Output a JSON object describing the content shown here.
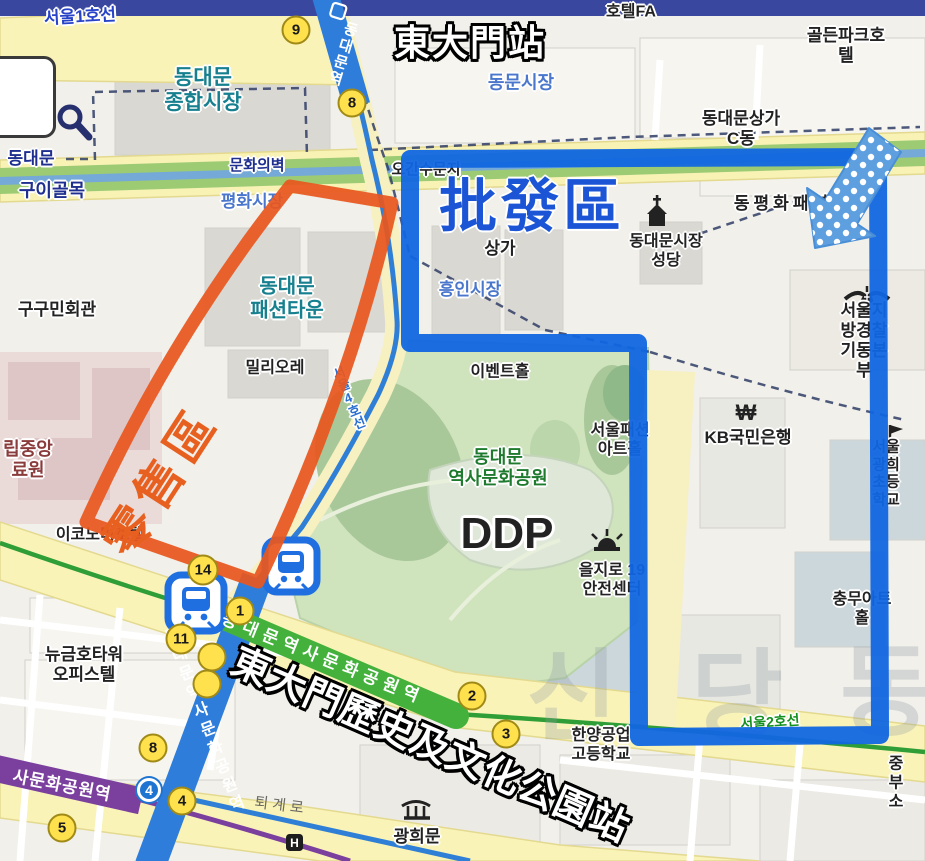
{
  "annotations": {
    "station_top": "東大門站",
    "wholesale_area": "批發區",
    "retail_area": "零售區",
    "station_bottom": "東大門歷史及文化公園站",
    "retail_color": "#e8571f",
    "wholesale_color": "#1166e0",
    "arrow_style": "blue-polka-dot"
  },
  "subway": {
    "badge4": "4",
    "ribbons": [
      {
        "id": "line4-top-name",
        "text": "동대문역",
        "x": 342,
        "y": 54,
        "rot": 17,
        "vertical": true,
        "size": 15,
        "spacing": 2
      },
      {
        "id": "line4-south-name",
        "text": "동대문역사문화공원역",
        "x": 202,
        "y": 722,
        "rot": -21,
        "vertical": true,
        "size": 16,
        "spacing": 4
      },
      {
        "id": "line2-name",
        "text": "동대문역사문화공원역",
        "x": 323,
        "y": 659,
        "rot": 22,
        "vertical": false,
        "size": 17,
        "spacing": 6
      },
      {
        "id": "line5-name",
        "text": "사문화공원역",
        "x": 62,
        "y": 786,
        "rot": 11,
        "vertical": false,
        "size": 17,
        "spacing": 1
      }
    ]
  },
  "stations": [
    {
      "n": "9",
      "x": 296,
      "y": 30
    },
    {
      "n": "8",
      "x": 352,
      "y": 103
    },
    {
      "n": "14",
      "x": 203,
      "y": 570
    },
    {
      "n": "1",
      "x": 240,
      "y": 611
    },
    {
      "n": "11",
      "x": 181,
      "y": 639
    },
    {
      "n": "",
      "x": 212,
      "y": 657
    },
    {
      "n": "",
      "x": 207,
      "y": 684
    },
    {
      "n": "8",
      "x": 153,
      "y": 748
    },
    {
      "n": "4",
      "x": 182,
      "y": 801
    },
    {
      "n": "5",
      "x": 62,
      "y": 828
    },
    {
      "n": "2",
      "x": 472,
      "y": 696
    },
    {
      "n": "3",
      "x": 506,
      "y": 734
    }
  ],
  "labels": [
    {
      "id": "seoul-line1",
      "t": "서울1호선",
      "x": 80,
      "y": 17,
      "s": 17,
      "c": "line1",
      "b": 1,
      "r": -3,
      "halo": 1
    },
    {
      "id": "hotel-fa",
      "t": "호텔FA",
      "x": 631,
      "y": 13,
      "s": 16,
      "c": "black",
      "b": 1,
      "halo": 1
    },
    {
      "id": "golden-park-hotel",
      "t": "골든파크호텔",
      "x": 846,
      "y": 46,
      "s": 17,
      "c": "black",
      "b": 1,
      "halo": 1
    },
    {
      "id": "ddm-jonghap-market",
      "t": "동대문\n종합시장",
      "x": 203,
      "y": 91,
      "s": 21,
      "c": "teal",
      "b": 1,
      "halo": 1
    },
    {
      "id": "dongmun-market",
      "t": "동문시장",
      "x": 521,
      "y": 83,
      "s": 18,
      "c": "bluem",
      "b": 1,
      "halo": 1
    },
    {
      "id": "ddm-sangga-c",
      "t": "동대문상가\nC동",
      "x": 741,
      "y": 129,
      "s": 17,
      "c": "black",
      "b": 1,
      "halo": 1
    },
    {
      "id": "munhwa-wall",
      "t": "문화의벽",
      "x": 257,
      "y": 166,
      "s": 15,
      "c": "navy",
      "b": 1,
      "halo": 1
    },
    {
      "id": "ogansu-munji",
      "t": "오간수문지",
      "x": 426,
      "y": 170,
      "s": 15,
      "c": "black",
      "b": 1,
      "halo": 1
    },
    {
      "id": "dongdaemun-west",
      "t": "동대문",
      "x": 31,
      "y": 159,
      "s": 17,
      "c": "navy",
      "b": 1,
      "halo": 1
    },
    {
      "id": "gui-golmok",
      "t": "구이골목",
      "x": 52,
      "y": 191,
      "s": 18,
      "c": "navy",
      "b": 1,
      "halo": 1
    },
    {
      "id": "pyeonghwa-market",
      "t": "평화시장",
      "x": 252,
      "y": 202,
      "s": 17,
      "c": "bluem",
      "b": 1,
      "halo": 1
    },
    {
      "id": "dongpyeonghwa",
      "t": "동평화패션",
      "x": 783,
      "y": 204,
      "s": 17,
      "c": "black",
      "b": 1,
      "halo": 1,
      "sp": 4
    },
    {
      "id": "ddm-catholic",
      "t": "동대문시장\n성당",
      "x": 666,
      "y": 252,
      "s": 16,
      "c": "black",
      "b": 1,
      "halo": 1
    },
    {
      "id": "sangga",
      "t": "상가",
      "x": 500,
      "y": 249,
      "s": 17,
      "c": "black",
      "b": 1,
      "halo": 1
    },
    {
      "id": "heungin-market",
      "t": "흥인시장",
      "x": 470,
      "y": 290,
      "s": 17,
      "c": "bluem",
      "b": 1,
      "halo": 1
    },
    {
      "id": "gugumin-hall",
      "t": "구구민회관",
      "x": 57,
      "y": 310,
      "s": 17,
      "c": "black",
      "b": 1,
      "halo": 1
    },
    {
      "id": "ddm-fashion-town",
      "t": "동대문\n패션타운",
      "x": 287,
      "y": 299,
      "s": 20,
      "c": "teal",
      "b": 1,
      "halo": 1
    },
    {
      "id": "police-hq",
      "t": "서울지방경찰\n기동본부",
      "x": 864,
      "y": 341,
      "s": 17,
      "c": "black",
      "b": 1,
      "halo": 1
    },
    {
      "id": "milliore",
      "t": "밀리오레",
      "x": 275,
      "y": 369,
      "s": 16,
      "c": "black",
      "b": 1,
      "halo": 1
    },
    {
      "id": "event-hall",
      "t": "이벤트홀",
      "x": 500,
      "y": 373,
      "s": 16,
      "c": "black",
      "b": 1,
      "halo": 1
    },
    {
      "id": "nmc",
      "t": "립중앙\n료원",
      "x": 28,
      "y": 460,
      "s": 18,
      "c": "maroon",
      "b": 1,
      "halo": 1
    },
    {
      "id": "seoul-line4",
      "t": "서울4호선",
      "x": 348,
      "y": 398,
      "s": 13,
      "c": "line4",
      "b": 1,
      "r": -22,
      "v": 1,
      "halo": 1
    },
    {
      "id": "ddp-park",
      "t": "동대문\n역사문화공원",
      "x": 498,
      "y": 468,
      "s": 18,
      "c": "green",
      "b": 1,
      "halo": 1
    },
    {
      "id": "seoul-fashion-art-hall",
      "t": "서울패션\n아트홀",
      "x": 620,
      "y": 441,
      "s": 16,
      "c": "black",
      "b": 1,
      "halo": 1
    },
    {
      "id": "kb-bank",
      "t": "KB국민은행",
      "x": 748,
      "y": 438,
      "s": 17,
      "c": "black",
      "b": 1,
      "halo": 1
    },
    {
      "id": "gwanghee-elementary",
      "t": "서울광희\n초등학교",
      "x": 886,
      "y": 474,
      "s": 15,
      "c": "black",
      "b": 1,
      "halo": 1
    },
    {
      "id": "ddp",
      "t": "DDP",
      "x": 507,
      "y": 534,
      "s": 44,
      "c": "black",
      "b": 1,
      "halo": 2
    },
    {
      "id": "economy-hotel",
      "t": "이코노미호텔",
      "x": 100,
      "y": 536,
      "s": 16,
      "c": "black",
      "b": 1,
      "halo": 1
    },
    {
      "id": "euljiro-19",
      "t": "을지로 19\n안전센터",
      "x": 612,
      "y": 581,
      "s": 16,
      "c": "black",
      "b": 1,
      "halo": 1
    },
    {
      "id": "chungmu-art-hall",
      "t": "충무아트홀",
      "x": 862,
      "y": 610,
      "s": 16,
      "c": "black",
      "b": 1,
      "halo": 1
    },
    {
      "id": "new-geumho-tower",
      "t": "뉴금호타워\n오피스텔",
      "x": 84,
      "y": 665,
      "s": 17,
      "c": "black",
      "b": 1,
      "halo": 1
    },
    {
      "id": "hanyang-high",
      "t": "한양공업\n고등학교",
      "x": 601,
      "y": 746,
      "s": 16,
      "c": "black",
      "b": 1,
      "halo": 1
    },
    {
      "id": "seoul-line2",
      "t": "서울2호선",
      "x": 770,
      "y": 722,
      "s": 14,
      "c": "line2",
      "b": 1,
      "r": -4,
      "halo": 1
    },
    {
      "id": "toegye-ro",
      "t": "퇴계로",
      "x": 281,
      "y": 806,
      "s": 15,
      "c": "gray",
      "b": 0,
      "r": 7,
      "sp": 4
    },
    {
      "id": "jungbu",
      "t": "중부소",
      "x": 896,
      "y": 784,
      "s": 16,
      "c": "black",
      "b": 1,
      "halo": 1
    },
    {
      "id": "gwangheemun",
      "t": "광희문",
      "x": 417,
      "y": 837,
      "s": 17,
      "c": "black",
      "b": 1,
      "halo": 1
    }
  ],
  "watermark": {
    "chars": [
      "신",
      "당",
      "동"
    ],
    "positions": [
      [
        572,
        688
      ],
      [
        737,
        688
      ],
      [
        886,
        683
      ]
    ],
    "size": 100,
    "color": "#8b97a3",
    "opacity": 0.28
  }
}
